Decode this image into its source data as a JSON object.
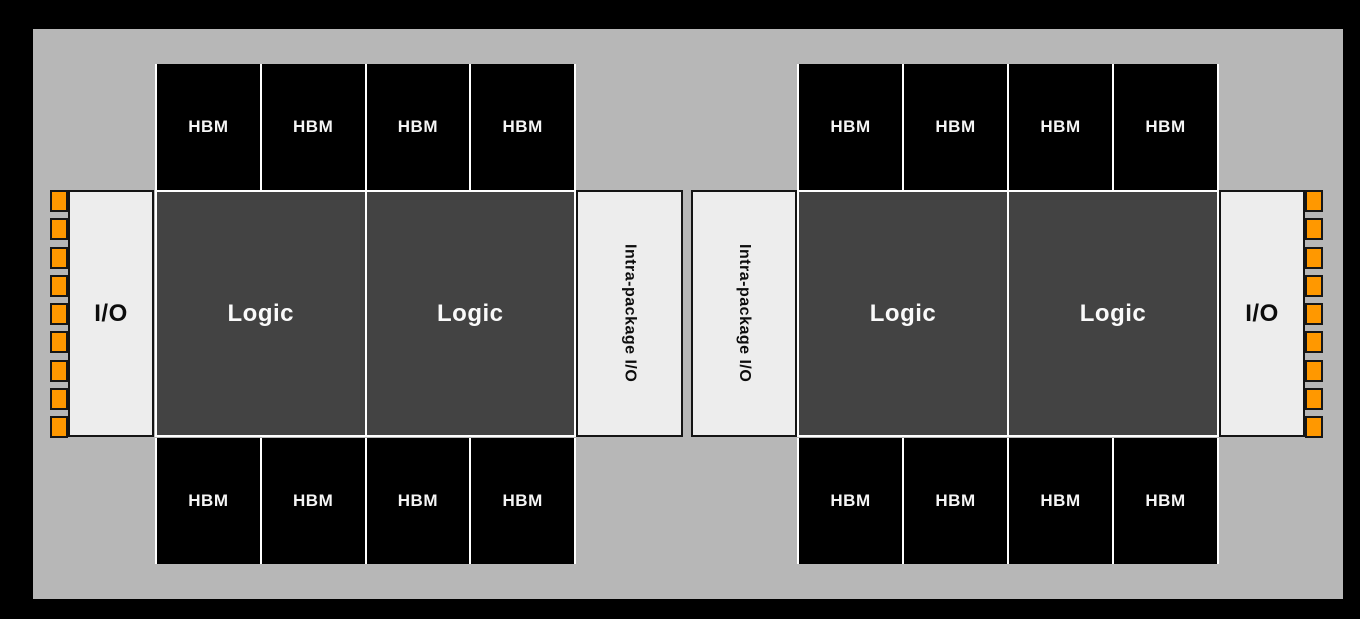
{
  "labels": {
    "hbm": "HBM",
    "logic": "Logic",
    "io": "I/O",
    "intra": "Intra-package I/O"
  },
  "colors": {
    "background": "#000000",
    "package": "#b7b7b7",
    "logic_die": "#434343",
    "hbm_die": "#000000",
    "io_die": "#ededed",
    "pad_orange": "#ff9800",
    "divider_white": "#ffffff"
  },
  "structure": {
    "hbm_per_row": 4,
    "io_pads_per_side": 9
  }
}
